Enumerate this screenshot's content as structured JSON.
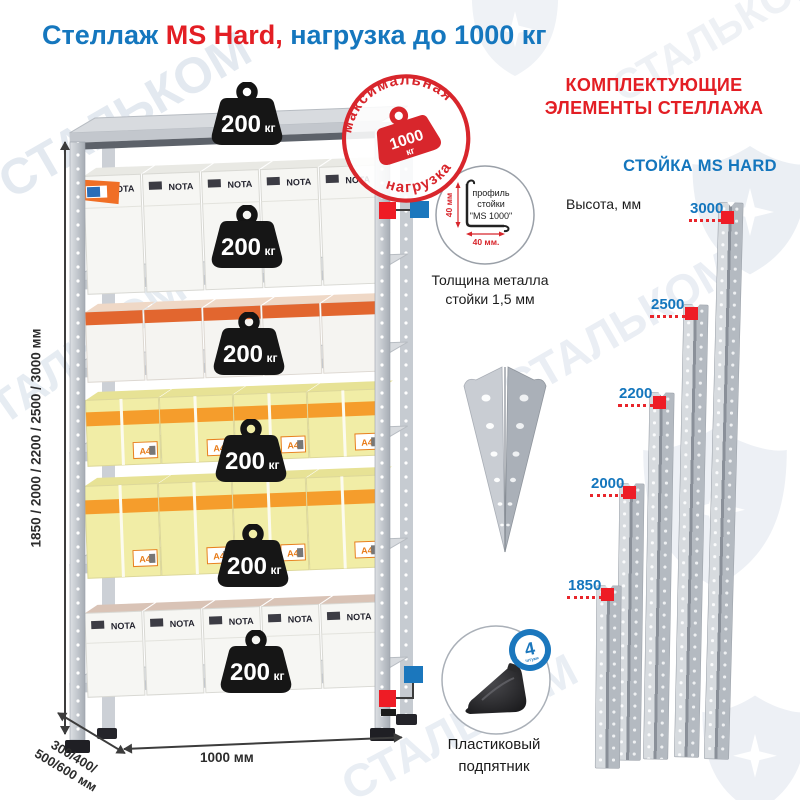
{
  "watermark_text": "СТАЛЬКОМ",
  "title": {
    "part_blue": "Стеллаж ",
    "part_red": "MS Hard, ",
    "part_blue2": "нагрузка до 1000 кг"
  },
  "stamp": {
    "arc_top": "максимальная",
    "arc_bottom": "нагрузка",
    "value": "1000",
    "unit": "кг"
  },
  "shelf_weight": {
    "value": "200",
    "unit": "кг"
  },
  "rack": {
    "box_brand": "NOTA",
    "box_label": "A4",
    "dim_height": "1850 / 2000 / 2200 / 2500 / 3000 мм",
    "dim_depth_line1": "300/400/",
    "dim_depth_line2": "500/600 мм",
    "dim_width": "1000 мм"
  },
  "profile_detail": {
    "line1": "профиль",
    "line2": "стойки",
    "line3": "\"MS 1000\"",
    "dim_v": "40 мм",
    "dim_h": "40 мм.",
    "thickness_line1": "Толщина металла",
    "thickness_line2": "стойки 1,5 мм"
  },
  "foot_detail": {
    "caption_line1": "Пластиковый",
    "caption_line2": "подпятник",
    "badge_count": "4",
    "badge_unit": "штуки",
    "badge_arc": "в комплекте"
  },
  "components": {
    "header_line1": "КОМПЛЕКТУЮЩИЕ",
    "header_line2": "ЭЛЕМЕНТЫ СТЕЛЛАЖА",
    "subheader": "СТОЙКА MS HARD",
    "height_label": "Высота, мм",
    "posts": [
      {
        "height": "3000"
      },
      {
        "height": "2500"
      },
      {
        "height": "2200"
      },
      {
        "height": "2000"
      },
      {
        "height": "1850"
      }
    ]
  },
  "colors": {
    "blue": "#1476bd",
    "red": "#e31e24",
    "stamp_red": "#d8262c",
    "marker_red": "#ee1c25",
    "marker_blue": "#1b77bd",
    "box_yellow": "#f1eda6",
    "box_orange": "#f59d2c",
    "metal_gray": "#c8ccd2"
  }
}
